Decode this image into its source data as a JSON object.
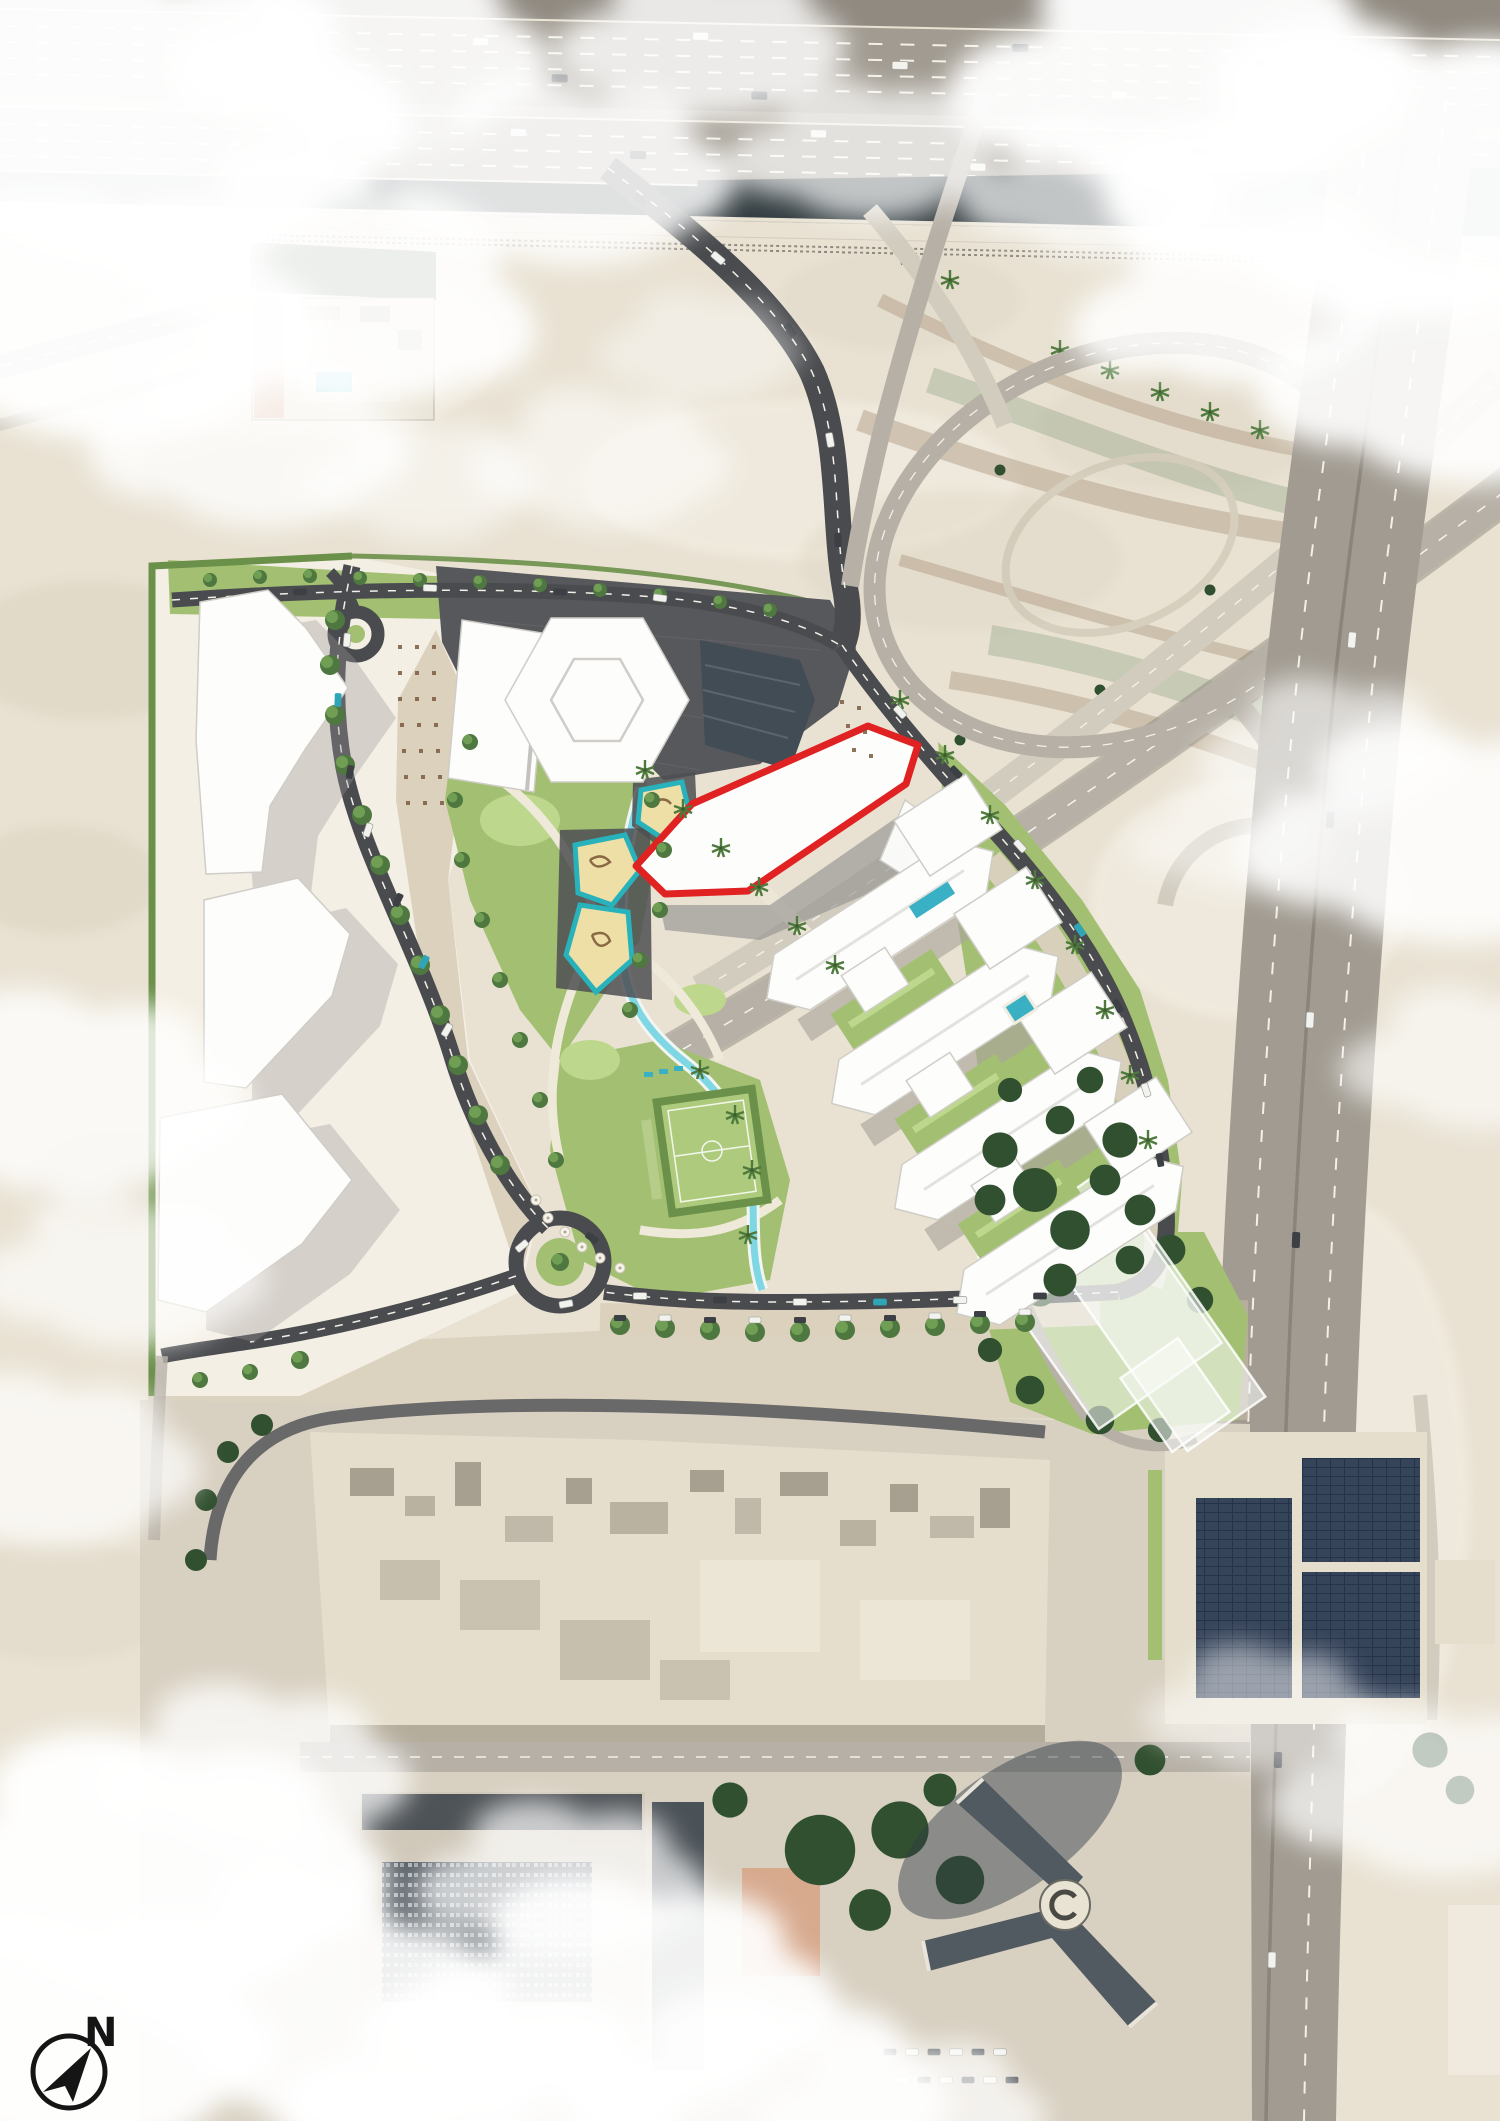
{
  "compass": {
    "label": "N",
    "icon": "north-arrow-in-circle"
  },
  "site_plan": {
    "highlighted_parcel_outline": "#e02222"
  },
  "colors": {
    "sand": "#e9e2d3",
    "sand_light": "#f4efe4",
    "sand_dark": "#cec2ab",
    "cloud": "#ffffff",
    "highway": "#a19b91",
    "highway_median": "#333d41",
    "road_mid": "#b6b0a6",
    "road_light": "#d2ccbf",
    "road_dark": "#494b4e",
    "dash": "#f2f0e8",
    "pave_beige": "#dbd1bc",
    "pave_light": "#ece6d6",
    "plaza_dark": "#57585c",
    "lawn": "#a3c072",
    "lawn_bright": "#bdd78c",
    "field_green": "#aecb7d",
    "hedge": "#6a9049",
    "tree": "#4e7840",
    "tree_light": "#6f9e54",
    "tree_dark": "#31502f",
    "stream": "#7fd7e4",
    "teal": "#28b2bc",
    "pool": "#3ab0c4",
    "play_sand": "#eedfa6",
    "play_equip": "#8a6a44",
    "bldg_white": "#fdfdfc",
    "bldg_edge": "#cfcdc7",
    "bldg_shadow": "#9a989c",
    "glass": "#424c55",
    "red": "#e02222",
    "ghost": "rgba(250,252,249,0.55)",
    "city_base": "#d8d0c1",
    "roof": "#e5decd",
    "roof_dark": "#a79f8f",
    "facade": "#525a61",
    "salmon": "#d7aa8e",
    "compass": "#151515"
  }
}
